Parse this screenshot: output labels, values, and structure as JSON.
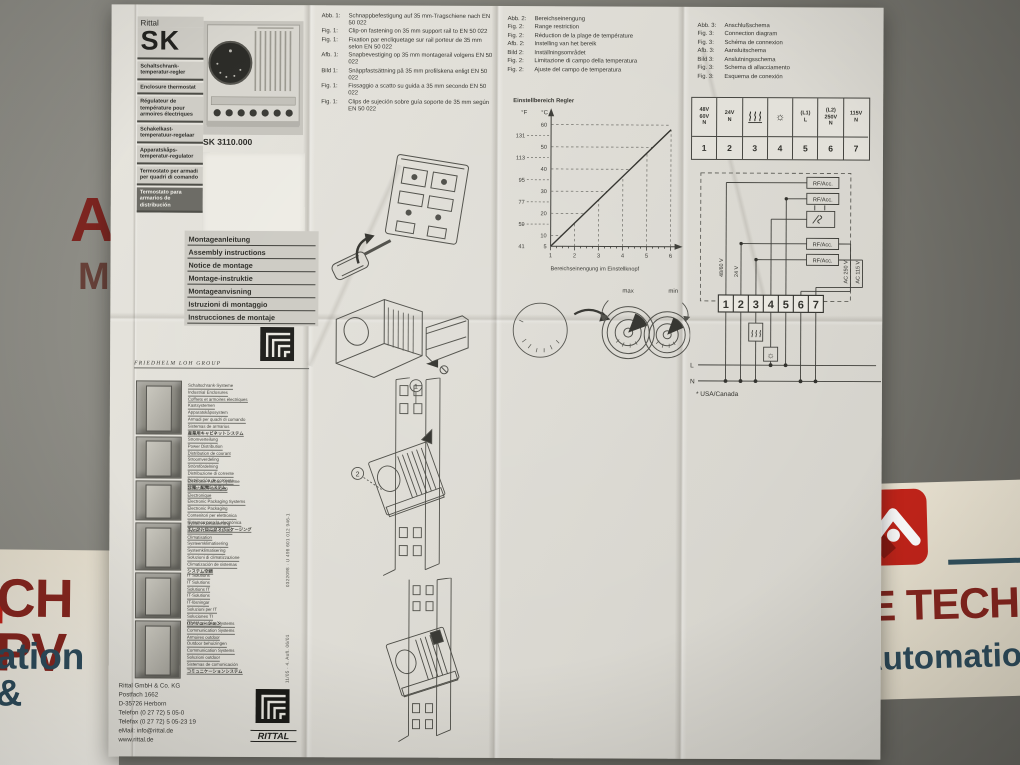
{
  "photo": {
    "watermarks": {
      "left_top": "AE",
      "left_mid": "Ma",
      "bottom_left_red": "CH PV",
      "bottom_left_blue": "ation &",
      "bottom_right_red": "E TECH",
      "bottom_right_blue": "Automatio",
      "red": "#c3241a",
      "dark_red": "#86261f",
      "blue": "#2e4c5c"
    }
  },
  "masthead": {
    "brand": "Rittal",
    "series": "SK",
    "product_names": [
      "Schaltschrank-temperatur-regler",
      "Enclosure thermostat",
      "Régulateur de température pour armoires électriques",
      "Schakelkast-temperatuur-regelaar",
      "Apparatskåps-temperatur-regulator",
      "Termostato per armadi per quadri di comando",
      "Termostato para armarios de distribución"
    ],
    "model": "SK 3110.000"
  },
  "instructions_title_langs": [
    "Montageanleitung",
    "Assembly instructions",
    "Notice de montage",
    "Montage-instruktie",
    "Montageanvisning",
    "Istruzioni di montaggio",
    "Instrucciones de montaje"
  ],
  "loh_group": {
    "header": "FRIEDHELM LOH GROUP",
    "sections": [
      {
        "lines": [
          "Schaltschrank-Systeme",
          "Industrial Enclosures",
          "Coffrets et armoires électriques",
          "Kastsystemen",
          "Apparatskåpssystem",
          "Armadi per quadri di comando",
          "Sistemas de armarios",
          "産業用キャビネットシステム"
        ]
      },
      {
        "lines": [
          "Stromverteilung",
          "Power Distribution",
          "Distribution de courant",
          "Stroomverdeling",
          "Strömfördelning",
          "Distribuzione di corrente",
          "Distribución de corriente",
          "分電・配電システム"
        ]
      },
      {
        "lines": [
          "Elektronik-Aufbau-Systeme",
          "Electronic Packaging",
          "Electronique",
          "Electronic Packaging Systems",
          "Electronic Packaging",
          "Contenitori per elettronica",
          "Sistemas para la electrónica",
          "エレクトロニクスパッケージング"
        ]
      },
      {
        "lines": [
          "System-Klimatisierung",
          "System Climate Control",
          "Climatisation",
          "Systeemklimatisering",
          "Systemklimatisering",
          "Soluzioni di climatizzazione",
          "Climatización de sistemas",
          "システム空調"
        ]
      },
      {
        "lines": [
          "IT Solutions",
          "IT Solutions",
          "Solutions IT",
          "IT-Solutions",
          "IT-lösningar",
          "Soluzioni per IT",
          "Soluciones TI",
          "ITソリューション"
        ]
      },
      {
        "lines": [
          "Communication Systems",
          "Communication Systems",
          "Armoires outdoor",
          "Outdoor behuizingen",
          "Communication Systems",
          "Soluzioni outdoor",
          "Sistemas de comunicación",
          "コミュニケーションシステム"
        ]
      }
    ]
  },
  "fig1": {
    "rows": [
      {
        "label": "Abb. 1:",
        "text": "Schnappbefestigung auf 35 mm-Tragschiene nach EN 50 022"
      },
      {
        "label": "Fig. 1:",
        "text": "Clip-on fastening on 35 mm support rail to EN 50 022"
      },
      {
        "label": "Fig. 1:",
        "text": "Fixation par encliquetage sur rail porteur de 35 mm selon EN 50 022"
      },
      {
        "label": "Afb. 1:",
        "text": "Snapbevestiging op 35 mm montagerail volgens EN 50 022"
      },
      {
        "label": "Bild 1:",
        "text": "Snäppfastsättning på 35 mm profilskena enligt EN 50 022"
      },
      {
        "label": "Fig. 1:",
        "text": "Fissaggio a scatto su guida a 35 mm secondo EN 50 022"
      },
      {
        "label": "Fig. 1:",
        "text": "Clips de sujeción sobre guía soporte de 35 mm según EN 50 022"
      }
    ],
    "callouts": [
      "1",
      "2"
    ]
  },
  "fig2": {
    "rows": [
      {
        "label": "Abb. 2:",
        "text": "Bereichseinengung"
      },
      {
        "label": "Fig. 2:",
        "text": "Range restriction"
      },
      {
        "label": "Fig. 2:",
        "text": "Réduction de la plage de température"
      },
      {
        "label": "Afb. 2:",
        "text": "Instelling van het bereik"
      },
      {
        "label": "Bild 2:",
        "text": "Inställningsområdet"
      },
      {
        "label": "Fig. 2:",
        "text": "Limitazione di campo della temperatura"
      },
      {
        "label": "Fig. 2:",
        "text": "Ajuste del campo de temperatura"
      }
    ],
    "dials": {
      "max": "max",
      "min": "min"
    }
  },
  "chart_data": {
    "type": "line",
    "title": "Einstellbereich Regler",
    "xlabel": "Bereichseinengung im Einstellknopf",
    "y_left_unit": "°F",
    "y_right_unit": "°C",
    "x_ticks": [
      1,
      2,
      3,
      4,
      5,
      6
    ],
    "c_ticks": [
      60,
      50,
      40,
      30,
      20,
      10,
      5
    ],
    "f_ticks": [
      131,
      113,
      95,
      77,
      59,
      41
    ],
    "line_points_x": [
      1,
      6
    ],
    "line_points_c": [
      5,
      58
    ],
    "ylim_c": [
      5,
      62
    ],
    "grid": "dashed"
  },
  "fig3": {
    "rows": [
      {
        "label": "Abb. 3:",
        "text": "Anschlußschema"
      },
      {
        "label": "Fig. 3:",
        "text": "Connection diagram"
      },
      {
        "label": "Fig. 3:",
        "text": "Schéma de connexion"
      },
      {
        "label": "Afb. 3:",
        "text": "Aansluitschema"
      },
      {
        "label": "Bild 3:",
        "text": "Anslutningsschema"
      },
      {
        "label": "Fig. 3:",
        "text": "Schema di allacciamento"
      },
      {
        "label": "Fig. 3:",
        "text": "Esquema de conexión"
      }
    ],
    "table": {
      "cells": [
        {
          "lines": [
            "48V",
            "60V",
            "N"
          ]
        },
        {
          "lines": [
            "24V",
            "N"
          ]
        },
        {
          "icon": "heater"
        },
        {
          "icon": "fan"
        },
        {
          "lines": [
            "(L1)",
            "L"
          ]
        },
        {
          "lines": [
            "(L2)",
            "250V",
            "N"
          ]
        },
        {
          "lines": [
            "115V",
            "N"
          ]
        }
      ],
      "numbers": [
        "1",
        "2",
        "3",
        "4",
        "5",
        "6",
        "7"
      ]
    },
    "diagram": {
      "rf": "RF/Acc.",
      "v4860": "48/60 V",
      "v24": "24 V",
      "v250": "AC 250 V",
      "v115": "AC 115 V",
      "l": "L",
      "n": "N",
      "note": "* USA/Canada"
    }
  },
  "imprint": {
    "lines": [
      "Rittal GmbH & Co. KG",
      "Postfach 1662",
      "D-35726 Herborn",
      "Telefon (0 27 72) 5 05-0",
      "Telefax (0 27 72) 5 05-23 19",
      "eMail: info@rittal.de",
      "www.rittal.de"
    ]
  },
  "print_codes": {
    "code1": "0322098 · U 498 601 012 946-1",
    "code2": "11/05 · 4. Aufl. 06/01"
  },
  "logos": {
    "rittal": "RITTAL"
  },
  "icons": {
    "fan": "☼"
  }
}
